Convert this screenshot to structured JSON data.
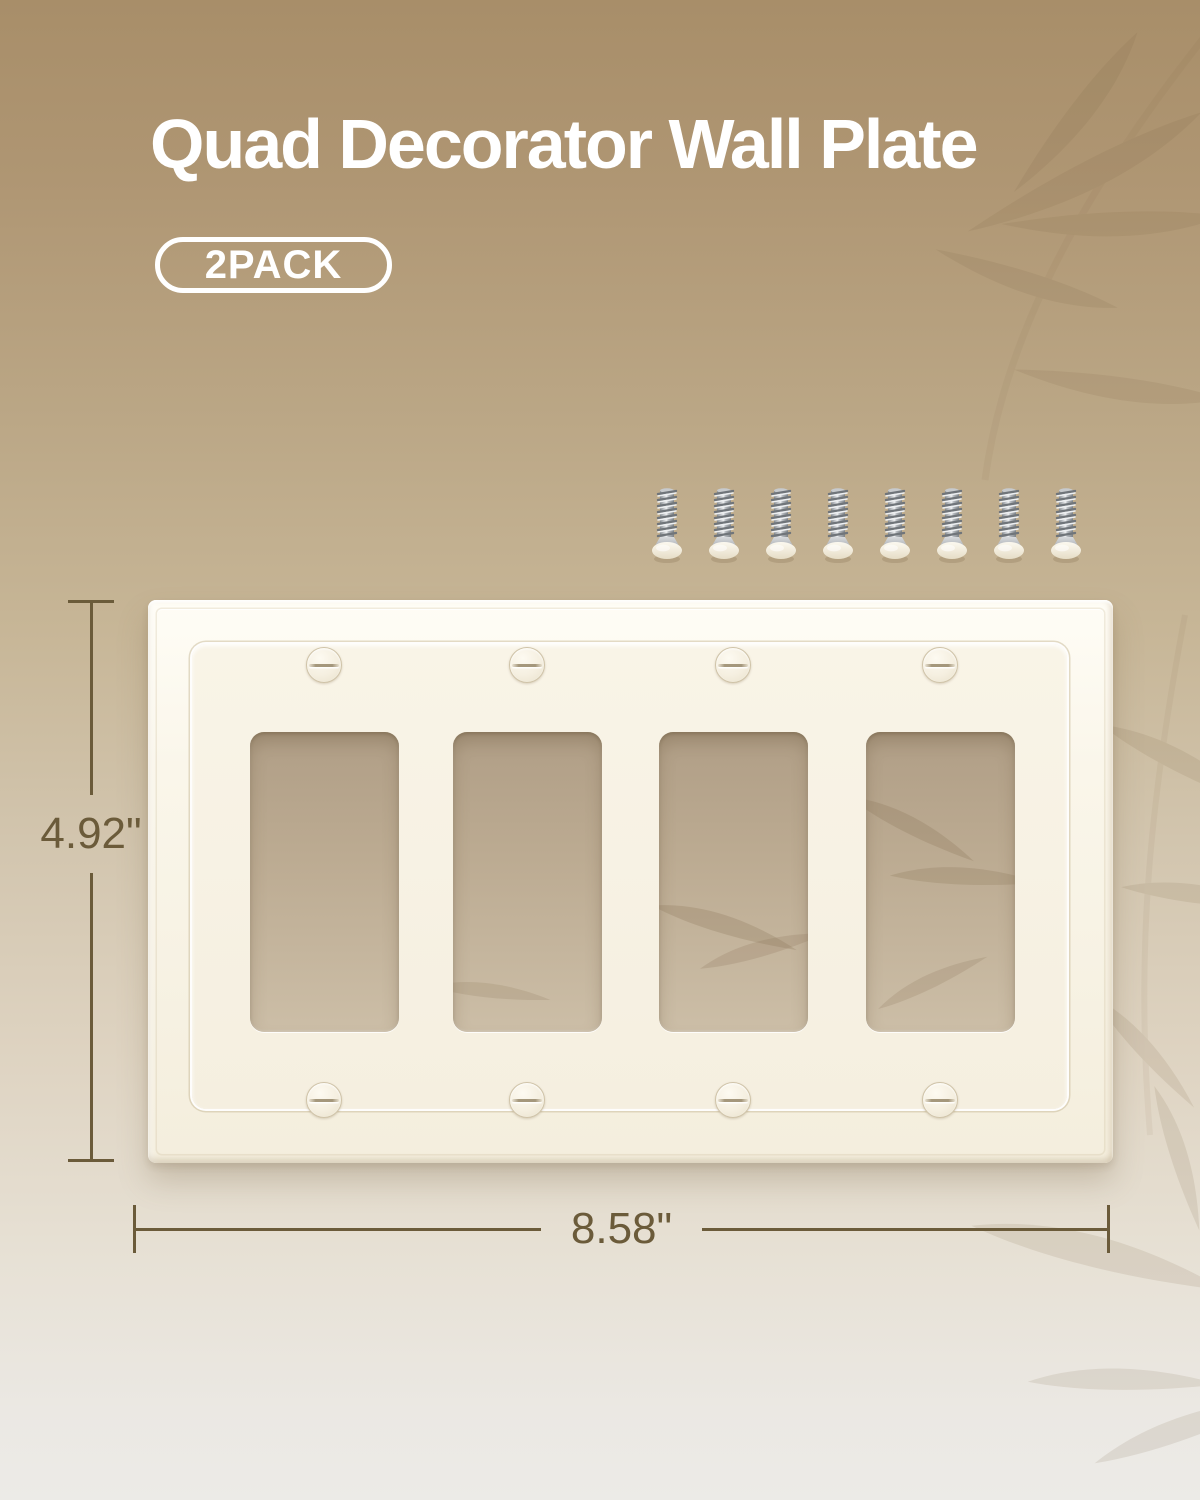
{
  "header": {
    "title": "Quad Decorator Wall Plate",
    "badge": "2PACK"
  },
  "product": {
    "name": "quad-decorator-wall-plate",
    "openings_count": 4,
    "screws_included": 8,
    "plate_color": "#f7f2e4"
  },
  "dimensions": {
    "height_label": "4.92\"",
    "width_label": "8.58\"",
    "line_color": "#6b5b3a"
  },
  "colors": {
    "background_top": "#a88e69",
    "background_bottom": "#ecebe7",
    "title_text": "#ffffff",
    "screw_metal": "#aab0b5",
    "watermark_leaf": "#7b6544"
  }
}
